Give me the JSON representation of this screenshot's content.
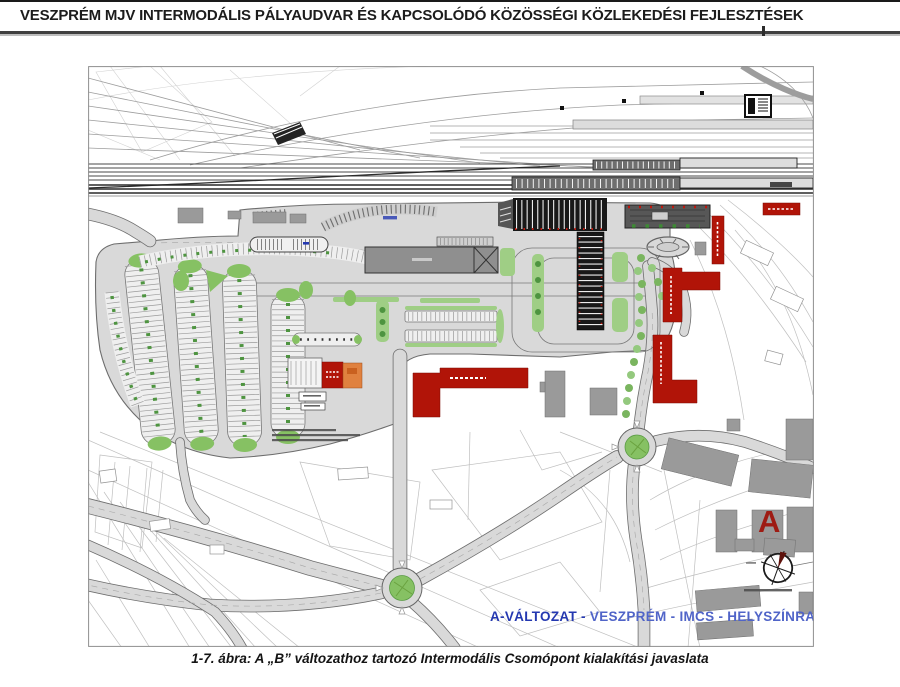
{
  "page": {
    "title": "VESZPRÉM MJV INTERMODÁLIS PÁLYAUDVAR ÉS KAPCSOLÓDÓ KÖZÖSSÉGI KÖZLEKEDÉSI FEJLESZTÉSEK",
    "caption": "1-7. ábra: A „B” változathoz tartozó Intermodális Csomópont kialakítási javaslata"
  },
  "plan": {
    "label_variant": "A-VÁLTOZAT -",
    "label_rest": " VESZPRÉM - IMCS - HELYSZÍNRAJZ  M 1:1000",
    "area_marker": "A",
    "colors": {
      "red": "#b11408",
      "orange": "#e0813f",
      "green": "#86c163",
      "green_light": "#9fce85",
      "tree": "#4e9440",
      "road": "#d9d9d9",
      "label_blue": "#2438b0",
      "label_blue2": "#5064c8",
      "marker": "#9e1b13"
    }
  }
}
